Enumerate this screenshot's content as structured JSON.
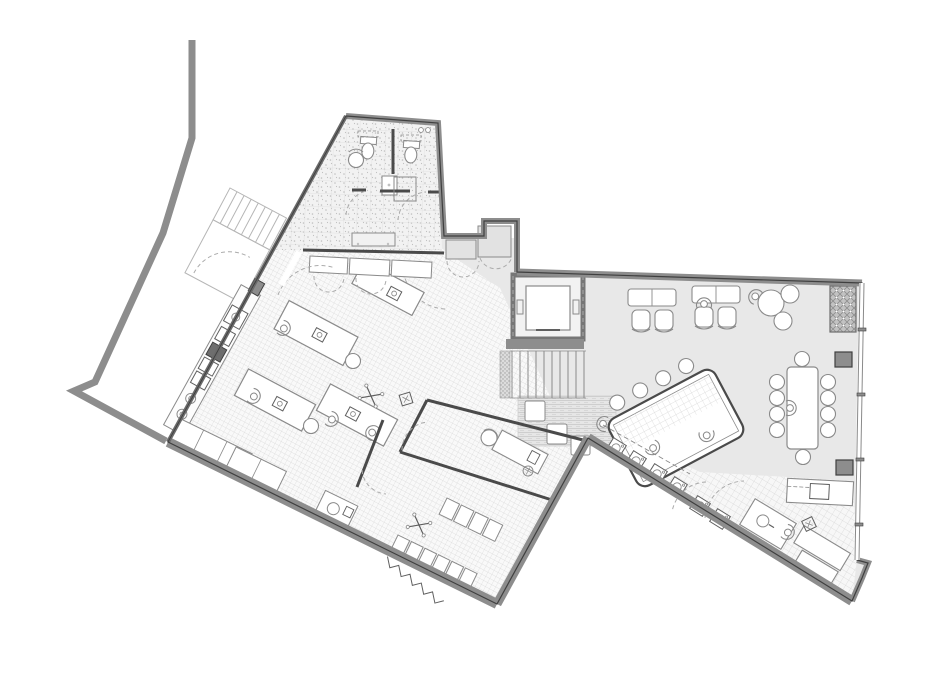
{
  "document": {
    "type": "architectural-floor-plan",
    "view": "top-down-plan",
    "visible_text": []
  },
  "palette": {
    "background": "#ffffff",
    "wall": "#8d8d8d",
    "wallDark": "#3f3f3f",
    "partition": "#4a4a4a",
    "furniture": "#8a8a8a",
    "furnitureDark": "#5f5f5f",
    "floorOpen": "#e8e8e8",
    "floorTileBg": "#f9f9f9",
    "tileLine": "#d7d7d7",
    "stippleBg": "#f2f2f2",
    "stippleDot": "#c0c0c0",
    "plankBg": "#e6e6e6",
    "plankLine": "#c9c9c9",
    "hatchBg": "#c2c2c2",
    "hatchLine": "#8f8f8f",
    "exterior": "#b5b5b5",
    "column": "#8d8d8d",
    "doorArc": "#ababab"
  },
  "plan": {
    "wings": [
      {
        "name": "left-wing",
        "floor": "fine-tile-grid",
        "rooms": [
          "wc-room",
          "shower-room",
          "workshop",
          "storage-room-west",
          "storage-room-south",
          "desk-nook"
        ]
      },
      {
        "name": "core",
        "rooms": [
          "entry-lobby",
          "elevator",
          "main-staircase",
          "lounge-mat"
        ]
      },
      {
        "name": "right-wing",
        "floor": "plain",
        "rooms": [
          "open-office",
          "meeting-area",
          "utility-corridor",
          "kitchen"
        ]
      }
    ],
    "fixtures": {
      "elevators": 1,
      "interior_staircases": 1,
      "exterior_staircases": 1,
      "toilets": 2,
      "sinks": 4,
      "workshop_tables": 4,
      "office_workstations": 2,
      "office_chairs": 4,
      "round_tables": 1,
      "conference_tables": 1,
      "conference_seats": 10,
      "worktable_stools": 4,
      "washer_appliances": 6,
      "kitchen_islands": 1,
      "person_figures": 11,
      "structural_columns": 3,
      "hatched_voids": 1,
      "door_swings": 10,
      "mat_poufs": 3,
      "shelf_bays": 10
    }
  }
}
